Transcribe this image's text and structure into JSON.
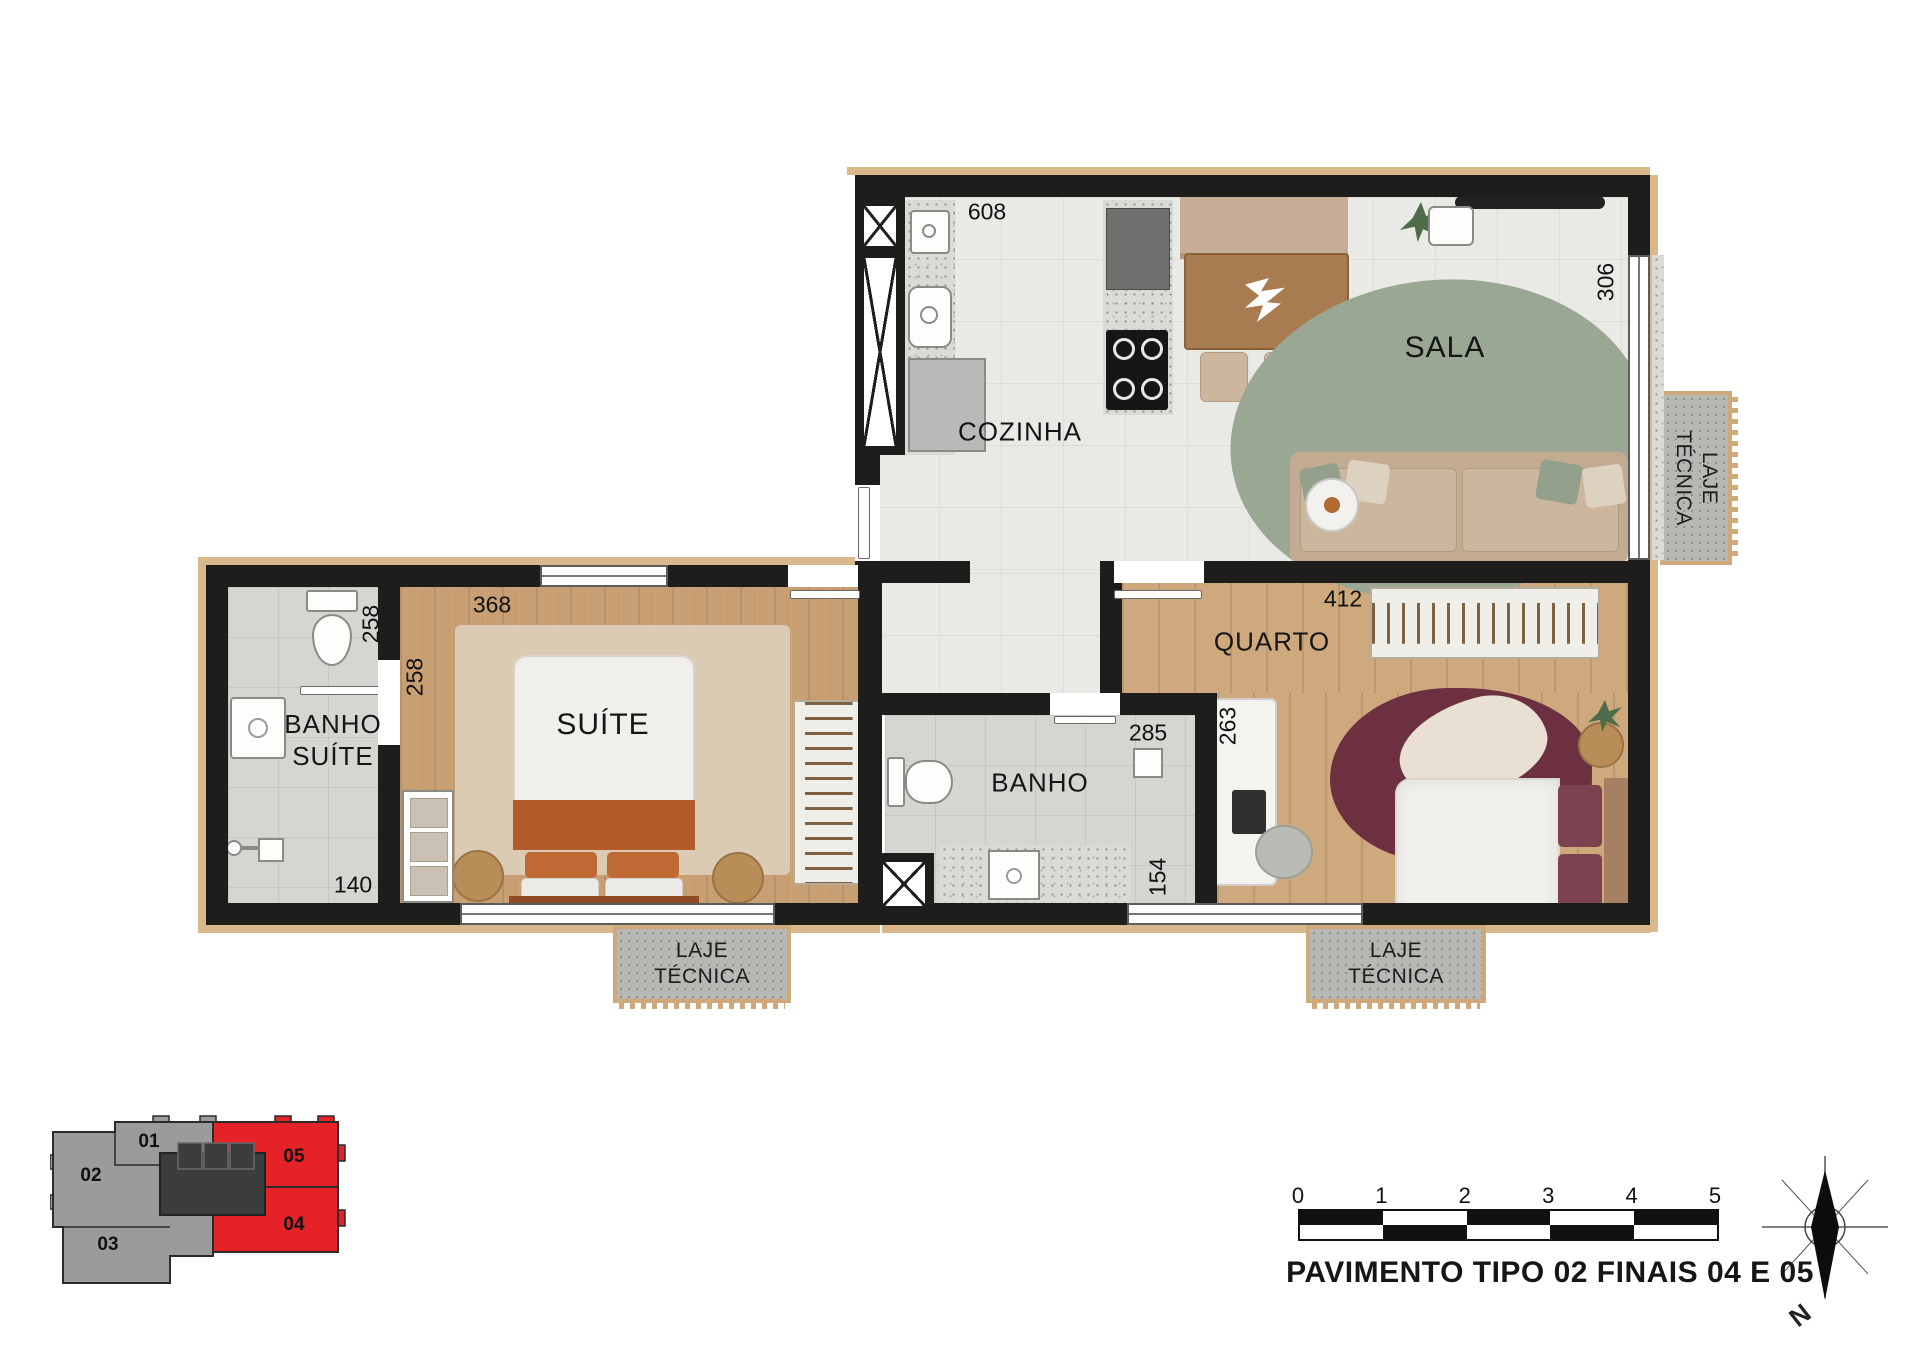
{
  "rooms": {
    "cozinha": "COZINHA",
    "sala": "SALA",
    "suite": "SUÍTE",
    "banho_suite_line1": "BANHO",
    "banho_suite_line2": "SUÍTE",
    "banho": "BANHO",
    "quarto": "QUARTO"
  },
  "dimensions": {
    "cozinha_width": "608",
    "sala_depth": "306",
    "suite_width": "368",
    "suite_depth_a": "258",
    "suite_depth_b": "258",
    "banho_suite_width": "140",
    "banho_width": "285",
    "quarto_desk_depth": "263",
    "banho_depth": "154",
    "quarto_width": "412"
  },
  "laje_tecnica": {
    "line1": "LAJE",
    "line2": "TÉCNICA"
  },
  "key_plan": {
    "units": [
      {
        "label": "01"
      },
      {
        "label": "02"
      },
      {
        "label": "03"
      },
      {
        "label": "04"
      },
      {
        "label": "05"
      }
    ],
    "highlighted_units": [
      "04",
      "05"
    ],
    "highlight_color": "#e52228",
    "muted_color": "#9b9b9b"
  },
  "scale_bar": {
    "ticks": [
      "0",
      "1",
      "2",
      "3",
      "4",
      "5"
    ]
  },
  "compass": {
    "north": "N"
  },
  "footer": {
    "title": "PAVIMENTO TIPO 02 FINAIS 04 E 05"
  },
  "colors": {
    "wall": "#1d1d1b",
    "slab_edge": "#d9b98c",
    "sala_rug": "#9aa893",
    "quarto_rug": "#6d3040"
  }
}
